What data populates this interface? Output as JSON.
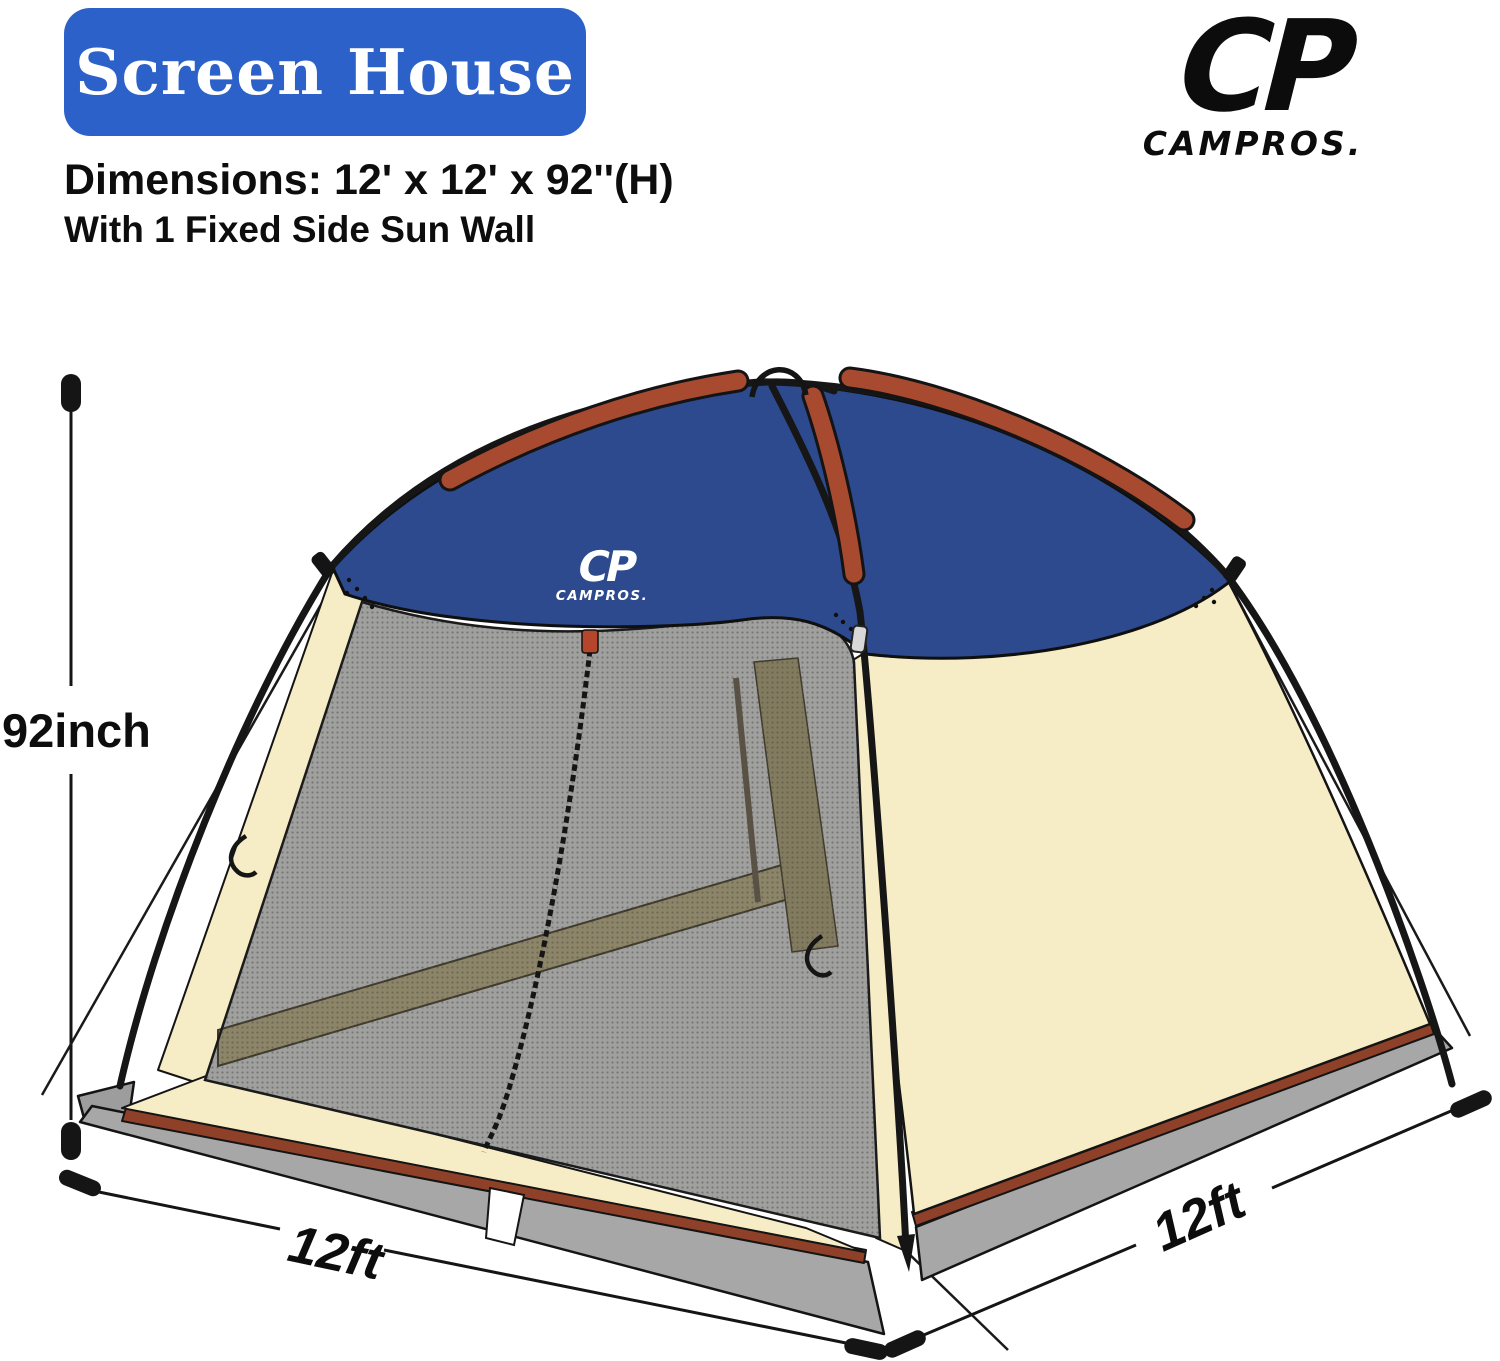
{
  "header": {
    "badge_label": "Screen House",
    "dimensions_line": "Dimensions: 12' x 12' x 92''(H)",
    "subtitle": "With 1 Fixed Side Sun Wall"
  },
  "brand": {
    "mark": "CP",
    "name": "CAMPROS."
  },
  "tent": {
    "canopy_mark": "CP",
    "canopy_brand": "CAMPROS."
  },
  "annotations": {
    "height": "92inch",
    "front_width": "12ft",
    "side_depth": "12ft"
  },
  "colors": {
    "badge_blue": "#2b61c8",
    "canopy_navy": "#2c4a8d",
    "pole_sleeve_red": "#a84a30",
    "trim_red": "#8e4128",
    "wall_beige": "#f6ecc5",
    "mesh_gray": "#a0a09e",
    "interior_khaki": "#8d8568",
    "skirt_gray": "#a7a7a7",
    "logo_black": "#0c0c0c"
  }
}
